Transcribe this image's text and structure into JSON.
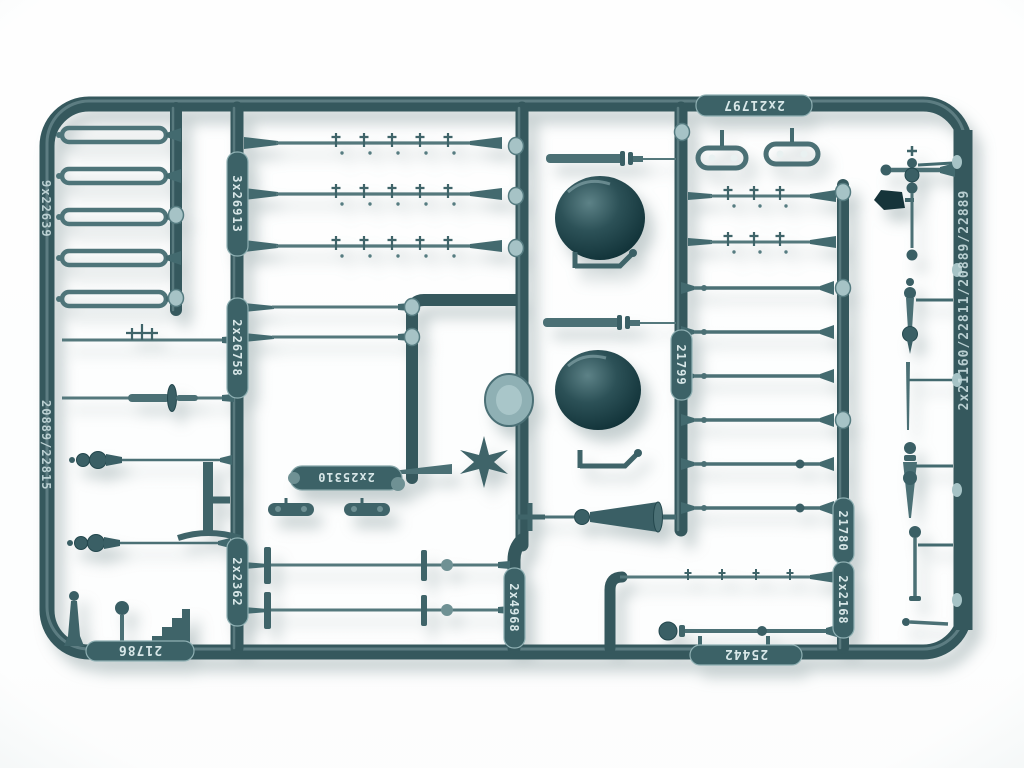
{
  "photo": {
    "labels": {
      "top_rail": "2x21797",
      "left_rail_upper": "9x22639",
      "left_rail_lower": "20889/22815",
      "left_runner_upper": "3x26913",
      "left_runner_mid": "2x26758",
      "left_runner_lower": "2x2362",
      "center_pill": "2x25310",
      "center_runner_bottom": "2x4968",
      "mid_runner": "21799",
      "right_runner_upper": "21780",
      "right_runner_lower": "2x2168",
      "bottom_rail_left": "21786",
      "bottom_rail_right": "25442",
      "right_rail": "2x21160/22811/20889/22889"
    },
    "palette": {
      "background": "#eef3f3",
      "plastic_dark": "#1c3c42",
      "plastic_mid": "#35585d",
      "plastic_light": "#7d9da0",
      "boss": "#a6c3c6",
      "emboss_text": "#d8e7e8",
      "shadow": "rgba(90,115,120,0.35)"
    }
  }
}
